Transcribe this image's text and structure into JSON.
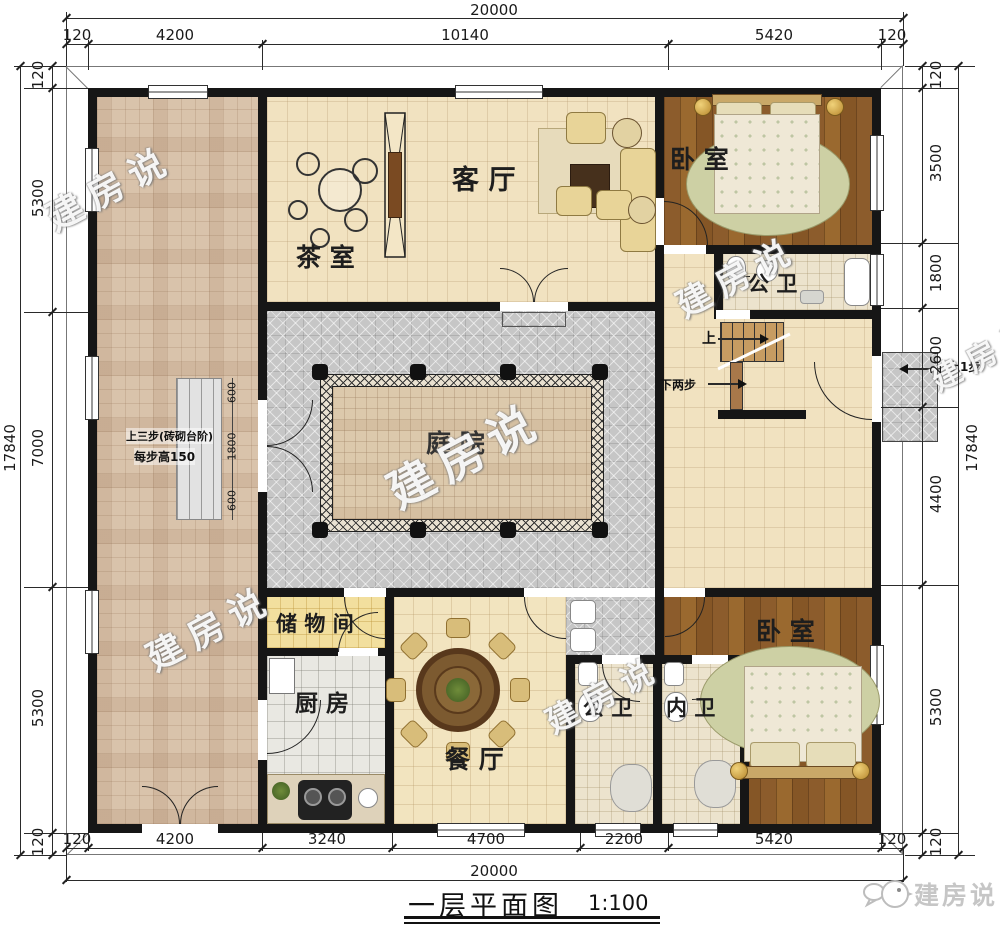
{
  "meta": {
    "title_caption": "一层平面图",
    "scale": "1:100",
    "brand": "建房说",
    "watermark": "建房说"
  },
  "dimensions": {
    "top": {
      "total": "20000",
      "segments": [
        "120",
        "4200",
        "10140",
        "5420",
        "120"
      ]
    },
    "bottom": {
      "total": "20000",
      "segments": [
        "120",
        "4200",
        "3240",
        "4700",
        "2200",
        "5420",
        "120"
      ]
    },
    "left": {
      "total": "17840",
      "segments": [
        "120",
        "5300",
        "7000",
        "5300",
        "120"
      ]
    },
    "right": {
      "total": "17840",
      "segments": [
        "120",
        "3500",
        "1800",
        "2600",
        "4400",
        "5300",
        "120"
      ]
    }
  },
  "rooms": {
    "tea_room": "茶室",
    "living_room": "客厅",
    "bedroom_top": "卧室",
    "bath_top": "公卫",
    "courtyard": "庭院",
    "storage": "储物间",
    "kitchen": "厨房",
    "dining": "餐厅",
    "bath_public": "公卫",
    "bath_ensuite": "内卫",
    "bedroom_bottom": "卧室"
  },
  "annotations": {
    "stair_up": "上",
    "stair_down_two": "下两步",
    "entry_step_right": "上1步",
    "steps_note_line1": "上三步(砖砌台阶)",
    "steps_note_line2": "每步高150",
    "steps_dims": [
      "600",
      "1800",
      "600"
    ]
  }
}
